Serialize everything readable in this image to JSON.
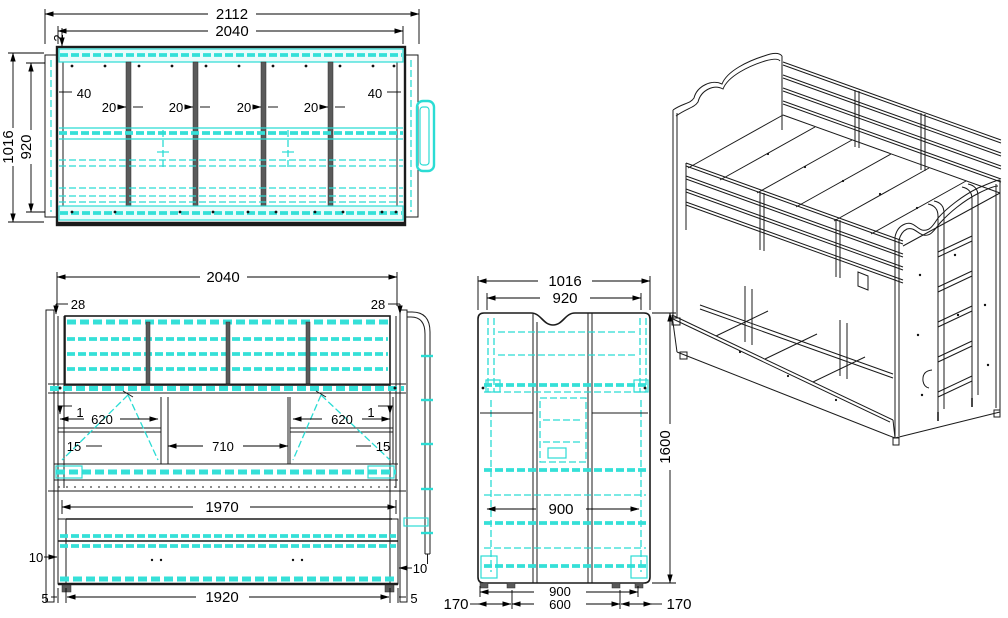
{
  "drawing": {
    "subject": "bunk-bed-with-trundle-technical-drawing",
    "colors": {
      "line": "#1b1b1b",
      "detail": "#2bdcd4",
      "dimension_text": "#000000",
      "background": "#ffffff"
    },
    "views": {
      "top": {
        "overall_length": "2112",
        "inner_length": "2040",
        "panel_offset": "2",
        "end_thickness_left": "40",
        "end_thickness_right": "40",
        "divider_1": "20",
        "divider_2": "20",
        "divider_3": "20",
        "divider_4": "20",
        "overall_depth": "1016",
        "inner_depth": "920"
      },
      "front": {
        "inner_length": "2040",
        "corner_offset_left": "28",
        "corner_offset_right": "28",
        "shelf_offset_left": "1",
        "shelf_offset_right": "1",
        "shelf_width_left": "620",
        "shelf_width_right": "620",
        "gap_left": "15",
        "gap_right": "15",
        "desk_opening_width": "710",
        "trundle_opening_width": "1970",
        "trundle_side_gap_left": "10",
        "trundle_side_gap_right": "10",
        "trundle_end_gap_left": "5",
        "trundle_end_gap_right": "5",
        "trundle_width": "1920"
      },
      "side": {
        "overall_width": "1016",
        "inner_width": "920",
        "overall_height": "1600",
        "inner_clear_width": "900",
        "foot_span": "900",
        "foot_inner_span": "600",
        "foot_inset_left": "170",
        "foot_inset_right": "170"
      }
    }
  }
}
